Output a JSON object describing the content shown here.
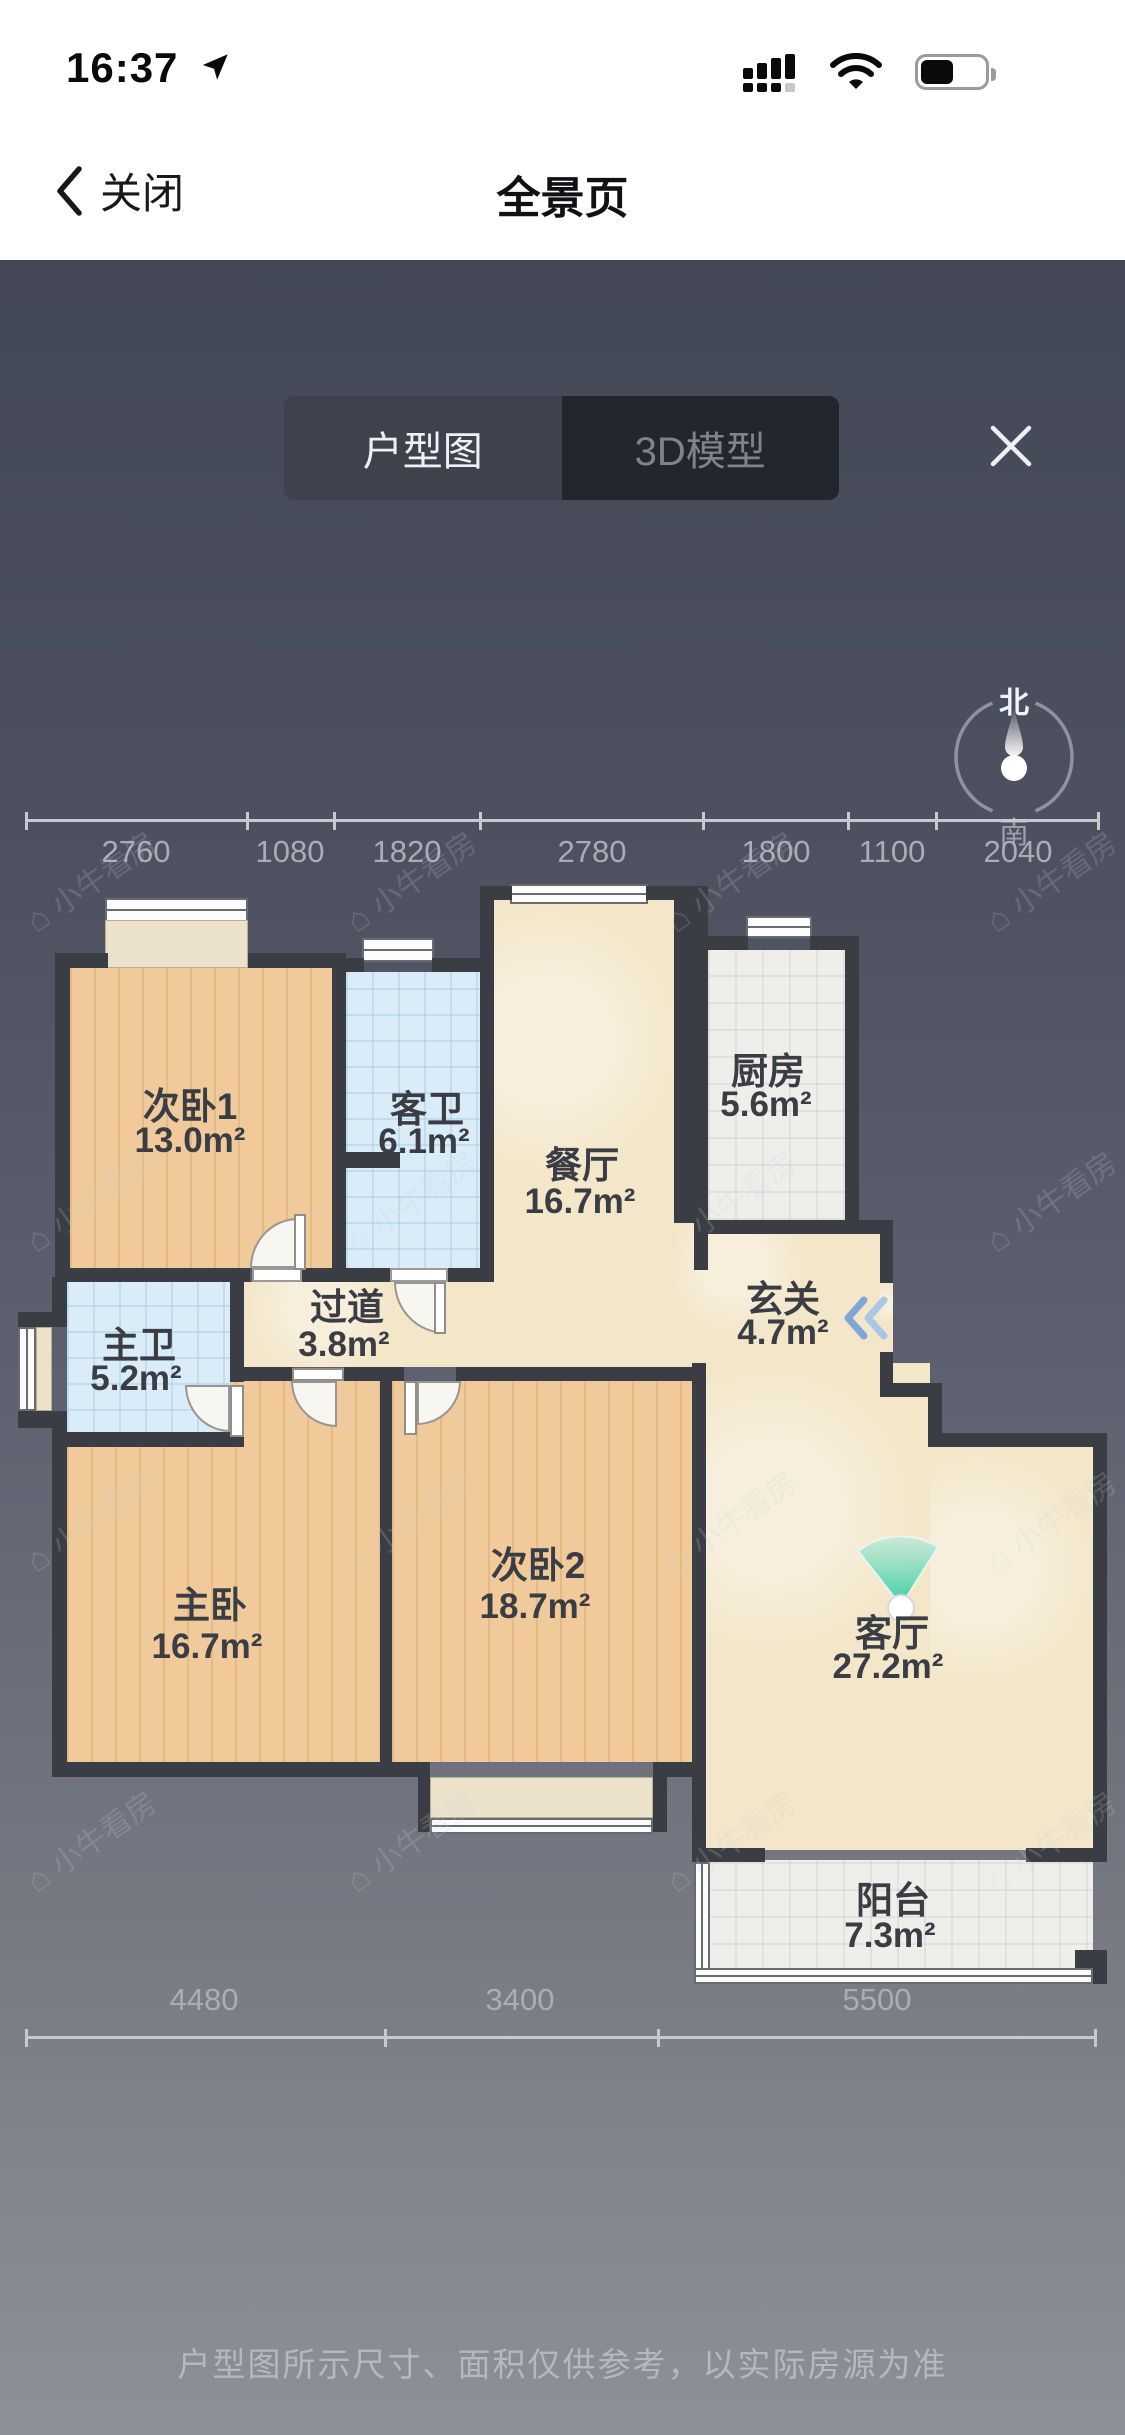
{
  "status_bar": {
    "time": "16:37"
  },
  "nav": {
    "back_label": "关闭",
    "title": "全景页"
  },
  "tabs": [
    {
      "label": "户型图",
      "active": true
    },
    {
      "label": "3D模型",
      "active": false
    }
  ],
  "compass": {
    "north": "北",
    "south": "南"
  },
  "dims_top": [
    "2760",
    "1080",
    "1820",
    "2780",
    "1800",
    "1100",
    "2040"
  ],
  "dims_bottom": [
    "4480",
    "3400",
    "5500"
  ],
  "rooms": [
    {
      "name": "次卧1",
      "area": "13.0m²"
    },
    {
      "name": "客卫",
      "area": "6.1m²"
    },
    {
      "name": "餐厅",
      "area": "16.7m²"
    },
    {
      "name": "厨房",
      "area": "5.6m²"
    },
    {
      "name": "玄关",
      "area": "4.7m²"
    },
    {
      "name": "主卫",
      "area": "5.2m²"
    },
    {
      "name": "过道",
      "area": "3.8m²"
    },
    {
      "name": "主卧",
      "area": "16.7m²"
    },
    {
      "name": "次卧2",
      "area": "18.7m²"
    },
    {
      "name": "客厅",
      "area": "27.2m²"
    },
    {
      "name": "阳台",
      "area": "7.3m²"
    }
  ],
  "watermark": {
    "text": "小牛看房"
  },
  "footer": {
    "disclaimer": "户型图所示尺寸、面积仅供参考，以实际房源为准"
  },
  "colors": {
    "accent_fan": "#3ecfa0",
    "wall": "#3a3d43",
    "wood_floor": "#efc795",
    "marble_floor": "#f3e6c9",
    "tile_blue": "#d9ecf7",
    "tab_active_bg": "#3d424d",
    "tab_inactive_bg": "#22262f"
  }
}
